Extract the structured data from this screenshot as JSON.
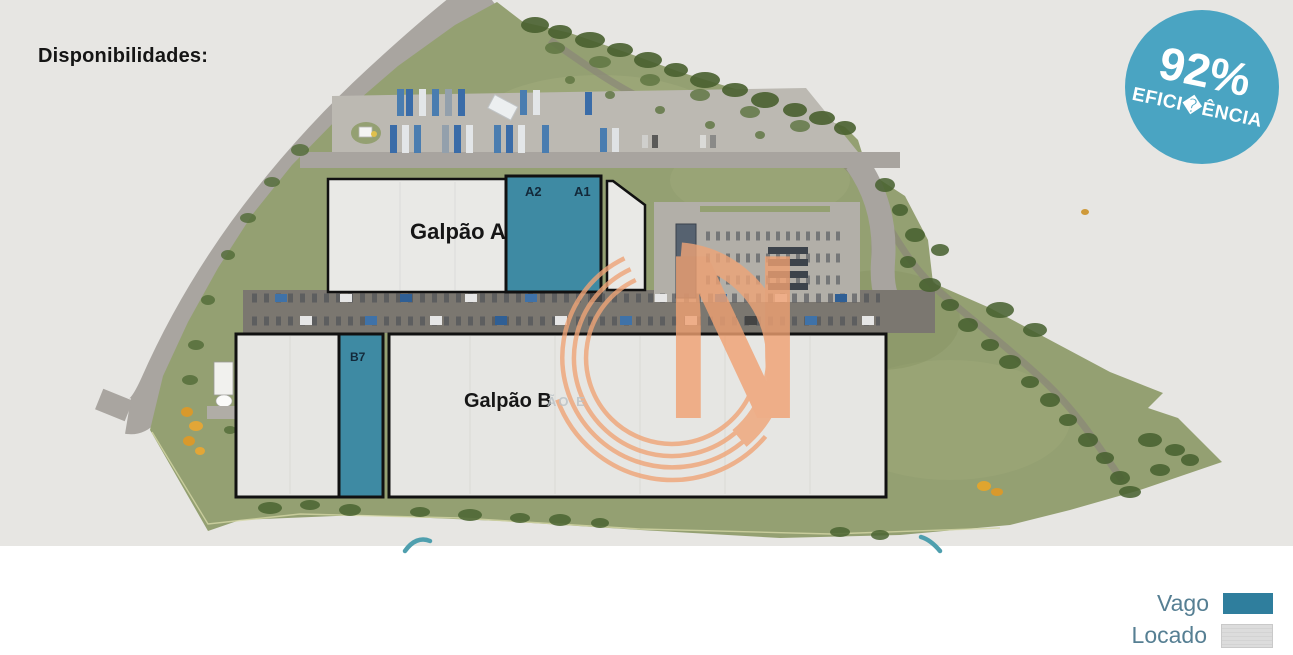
{
  "page": {
    "title": "Disponibilidades:"
  },
  "badge": {
    "value": "92%",
    "label": "EFICI�ÊNCIA",
    "color": "#4aa4c2"
  },
  "map": {
    "buildings": [
      {
        "name": "Galpão A",
        "vacant_sections": [
          "A2",
          "A1"
        ]
      },
      {
        "name": "Galpão B",
        "vacant_sections": [
          "B7"
        ]
      }
    ],
    "watermark_letter": "N",
    "watermark_fragment": "ÃO E"
  },
  "legend": [
    {
      "label": "Vago",
      "color": "#2f7e9d"
    },
    {
      "label": "Locado",
      "color": "#dadada"
    }
  ],
  "colors": {
    "vacant_fill": "#3e8aa3",
    "leased_fill": "#e9e9e6",
    "terrain": "#94a072",
    "badge": "#4aa4c2",
    "watermark": "#f0a172"
  }
}
